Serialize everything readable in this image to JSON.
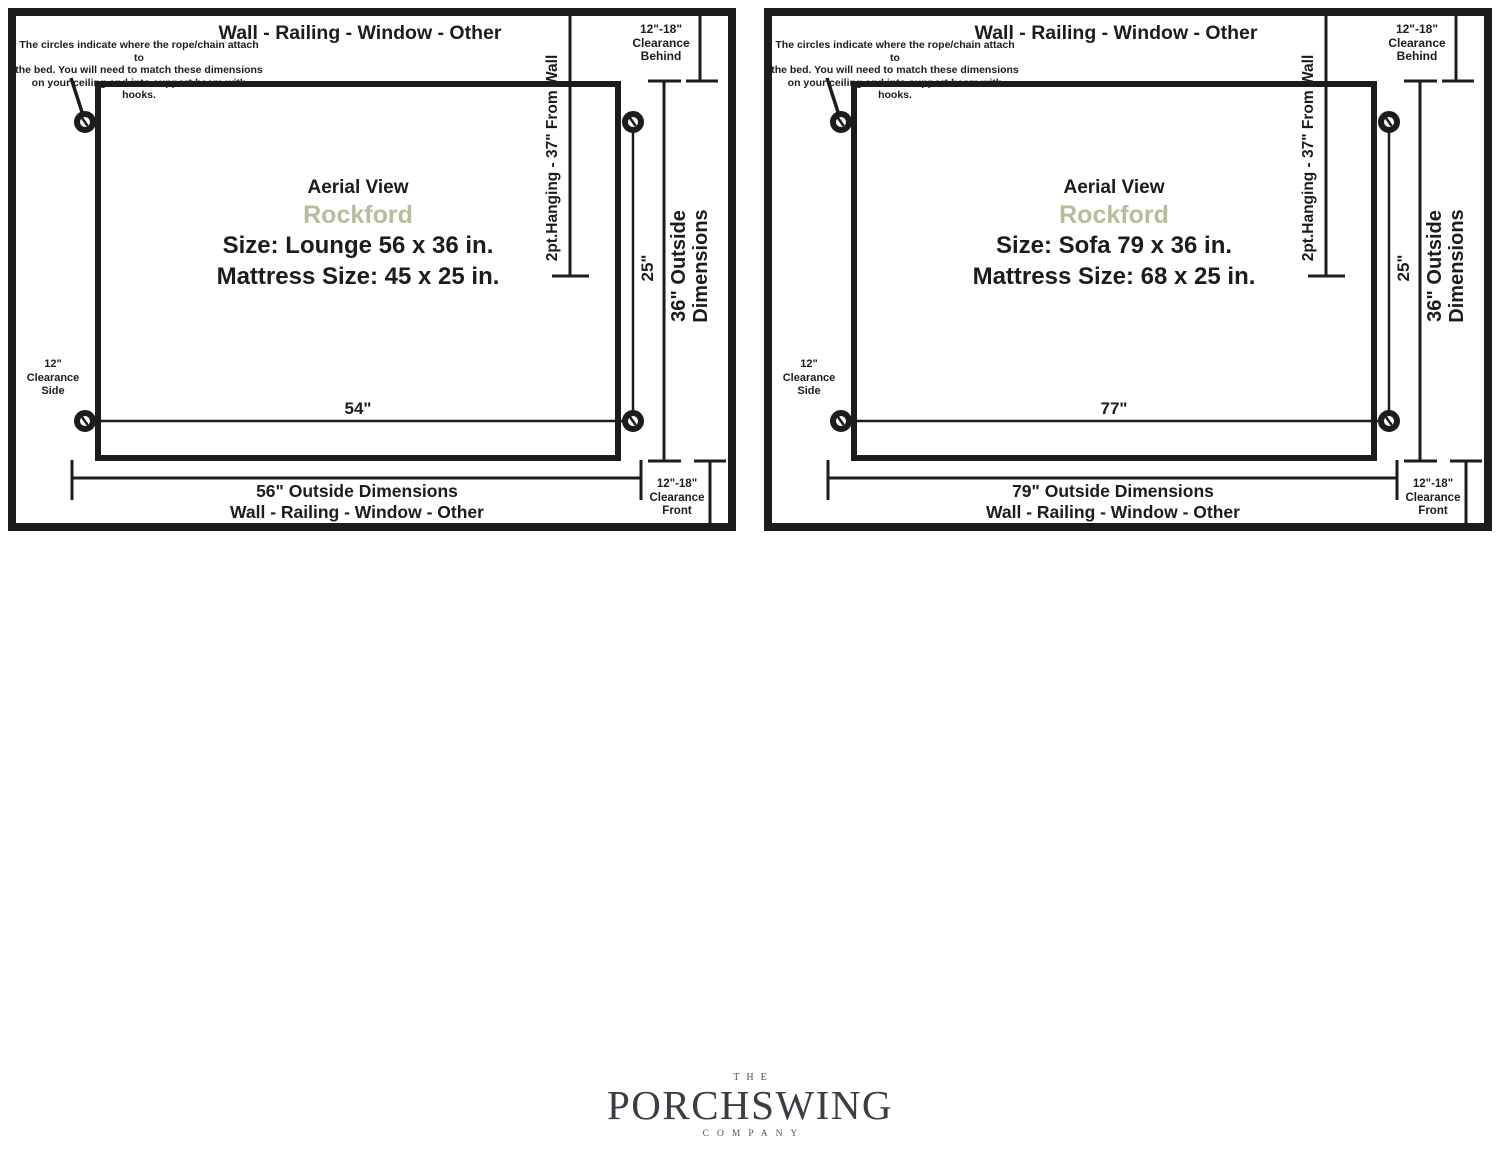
{
  "colors": {
    "line": "#1c1c1c",
    "accent_product_name": "#b9bc9b",
    "logo": "#3d3c44",
    "background": "#ffffff"
  },
  "panels": [
    {
      "wall_label_top": "Wall - Railing - Window - Other",
      "note": [
        "The circles indicate where the rope/chain attach to",
        "the bed. You will need to match these dimensions",
        "on your ceiling and into support beam with hooks."
      ],
      "hanging_label": "2pt.Hanging - 37\" From Wall",
      "clearance_behind": [
        "12\"-18\"",
        "Clearance",
        "Behind"
      ],
      "clearance_side": [
        "12\"",
        "Clearance",
        "Side"
      ],
      "clearance_front": [
        "12\"-18\"",
        "Clearance",
        "Front"
      ],
      "view_label": "Aerial View",
      "product_name": "Rockford",
      "size_text": "Size: Lounge 56 x 36 in.",
      "mattress_text": "Mattress Size: 45 x 25 in.",
      "attach_width_label": "54\"",
      "attach_depth_label": "25\"",
      "outside_depth_lines": [
        "36\" Outside",
        "Dimensions"
      ],
      "outside_width_label": "56\" Outside Dimensions",
      "wall_label_bottom": "Wall - Railing - Window - Other"
    },
    {
      "wall_label_top": "Wall - Railing - Window - Other",
      "note": [
        "The circles indicate where the rope/chain attach to",
        "the bed. You will need to match these dimensions",
        "on your ceiling and into support beam with hooks."
      ],
      "hanging_label": "2pt.Hanging - 37\" From Wall",
      "clearance_behind": [
        "12\"-18\"",
        "Clearance",
        "Behind"
      ],
      "clearance_side": [
        "12\"",
        "Clearance",
        "Side"
      ],
      "clearance_front": [
        "12\"-18\"",
        "Clearance",
        "Front"
      ],
      "view_label": "Aerial View",
      "product_name": "Rockford",
      "size_text": "Size: Sofa 79 x 36 in.",
      "mattress_text": "Mattress Size: 68 x 25 in.",
      "attach_width_label": "77\"",
      "attach_depth_label": "25\"",
      "outside_depth_lines": [
        "36\" Outside",
        "Dimensions"
      ],
      "outside_width_label": "79\" Outside Dimensions",
      "wall_label_bottom": "Wall - Railing - Window - Other"
    }
  ],
  "logo": {
    "the": "THE",
    "name": "PORCHSWING",
    "company": "COMPANY"
  }
}
